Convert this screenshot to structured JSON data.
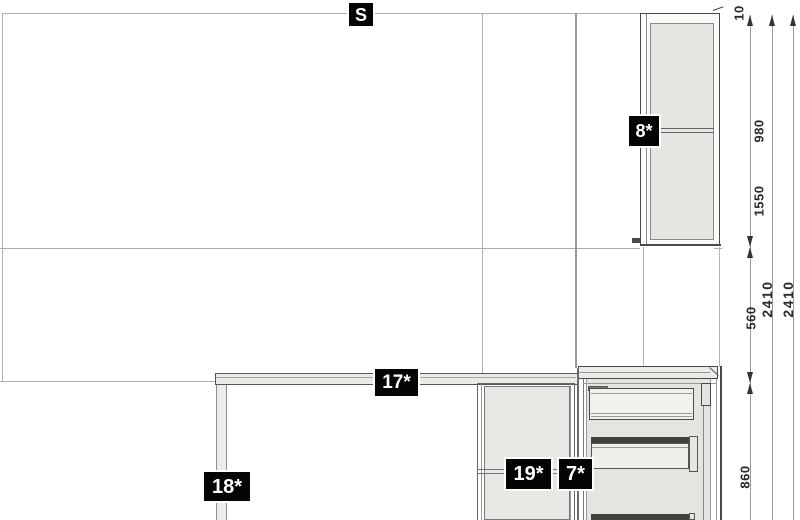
{
  "view": {
    "type": "elevation-drawing",
    "wall": {
      "label": "S"
    }
  },
  "items": [
    {
      "id": "wall-cabinet-8",
      "label": "8*"
    },
    {
      "id": "worktop-17",
      "label": "17*"
    },
    {
      "id": "table-leg-18",
      "label": "18*"
    },
    {
      "id": "base-cabinet-19",
      "label": "19*"
    },
    {
      "id": "drawer-unit-7",
      "label": "7*"
    }
  ],
  "dimensions": {
    "right_chain": [
      "10",
      "980",
      "1550",
      "560",
      "860"
    ],
    "totals": [
      "2410",
      "2410"
    ]
  },
  "colors": {
    "background": "#ffffff",
    "construction_line": "#aeaeae",
    "outline_dark": "#4a4a4a",
    "cabinet_fill": "#e6e6e3",
    "worktop_fill": "#eaeae7",
    "drawer_gap": "#41413e",
    "label_bg": "#050505",
    "label_text": "#ffffff",
    "dimension_text": "#2b2b2b"
  }
}
